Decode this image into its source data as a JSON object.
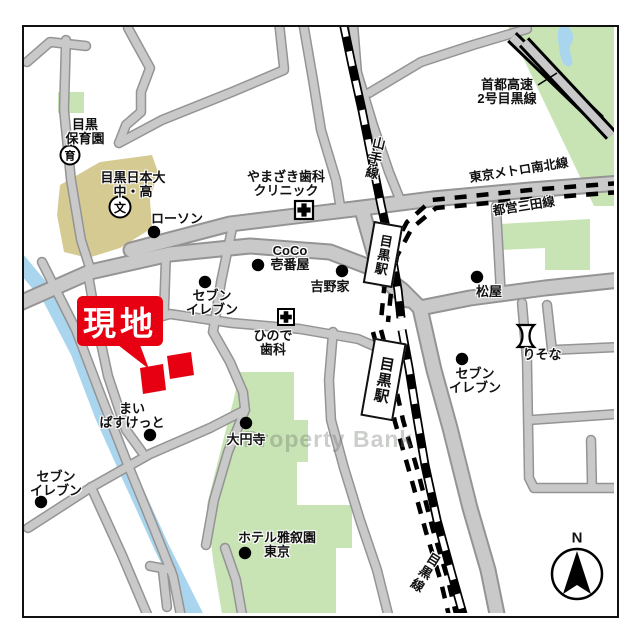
{
  "watermark": "Property Bank",
  "compass": {
    "north_label": "N"
  },
  "site": {
    "label": "現地"
  },
  "stations": [
    {
      "name": "目黒駅"
    },
    {
      "name": "目黒駅"
    }
  ],
  "rail_lines": {
    "yamanote": "山手線",
    "meguro": "目黒線",
    "namboku": "東京メトロ南北線",
    "mita": "都営三田線",
    "shuto_line1": "首都高速",
    "shuto_line2": "2号目黒線"
  },
  "places": [
    {
      "id": "meguro-hoikuen",
      "line1": "目黒",
      "line2": "保育園",
      "icon": "育"
    },
    {
      "id": "meguro-nihon-univ-school",
      "line1": "目黒日本大",
      "line2": "中・高",
      "icon": "文"
    },
    {
      "id": "lawson",
      "line1": "ローソン"
    },
    {
      "id": "yamazaki-dental-clinic",
      "line1": "やまざき歯科",
      "line2": "クリニック"
    },
    {
      "id": "coco-ichibanya",
      "line1": "CoCo",
      "line2": "壱番屋"
    },
    {
      "id": "yoshinoya",
      "line1": "吉野家"
    },
    {
      "id": "matsuya",
      "line1": "松屋"
    },
    {
      "id": "seven-eleven-east",
      "line1": "セブン",
      "line2": "イレブン"
    },
    {
      "id": "resona-bank",
      "line1": "りそな"
    },
    {
      "id": "seven-eleven-center",
      "line1": "セブン",
      "line2": "イレブン"
    },
    {
      "id": "hinode-dental",
      "line1": "ひので",
      "line2": "歯科"
    },
    {
      "id": "my-basket",
      "line1": "まい",
      "line2": "ぱすけっと"
    },
    {
      "id": "daienji-temple",
      "line1": "大円寺"
    },
    {
      "id": "hotel-gajoen-tokyo",
      "line1": "ホテル雅叙園",
      "line2": "東京"
    },
    {
      "id": "seven-eleven-southwest",
      "line1": "セブン",
      "line2": "イレブン"
    }
  ],
  "colors": {
    "road": "#c9c9c9",
    "road_edge": "#949494",
    "green_area": "#c8e4b4",
    "water": "#a9d6ee",
    "school_area": "#d5ca92",
    "site_red": "#e60012",
    "rail_black": "#000000"
  }
}
